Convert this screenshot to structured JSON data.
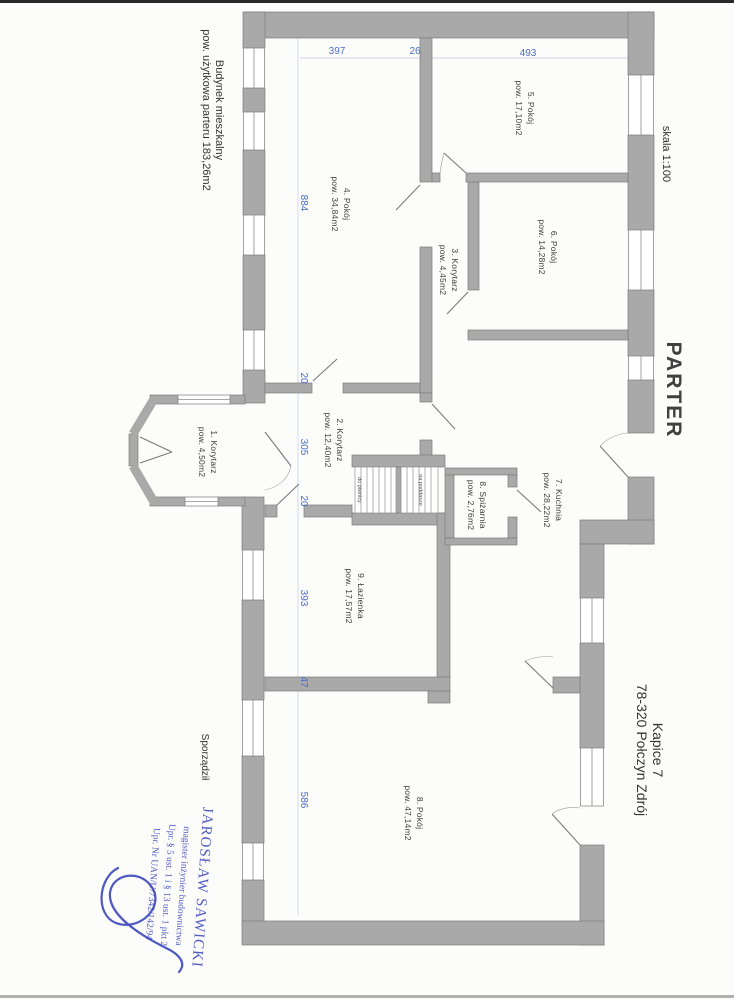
{
  "title": {
    "line1": "Budynek mieszkalny",
    "line2": "pow. użytkowa parteru 183,26m2"
  },
  "scale_label": "skala 1:100",
  "floor_label": "PARTER",
  "address": {
    "line1": "Kapice 7",
    "line2": "78-320 Połczyn Zdrój"
  },
  "prepared_by_label": "Sporządził",
  "stamp": {
    "line1": "JAROSŁAW SAWICKI",
    "line2": "magister inżynier budownictwa",
    "line3": "Upr. § 5 ust. 1 i § 13 ust. 1 pkt 2",
    "line4": "Upr. Nr UAN/U/7342/142/94"
  },
  "rooms": {
    "r1": {
      "name": "1. Korytarz",
      "area": "pow. 4,50m2"
    },
    "r2": {
      "name": "2. Korytarz",
      "area": "pow. 12,40m2"
    },
    "r3": {
      "name": "3. Korytarz",
      "area": "pow. 4,45m2"
    },
    "r4": {
      "name": "4. Pokój",
      "area": "pow. 34,84m2"
    },
    "r5": {
      "name": "5. Pokój",
      "area": "pow. 17,10m2"
    },
    "r6": {
      "name": "6. Pokój",
      "area": "pow. 14,28m2"
    },
    "r7": {
      "name": "7. Kuchnia",
      "area": "pow. 28,22m2"
    },
    "r8": {
      "name": "8. Spiżarnia",
      "area": "pow. 2,76m2"
    },
    "r9": {
      "name": "9. Łazienka",
      "area": "pow. 17,57m2"
    },
    "r10": {
      "name": "8. Pokój",
      "area": "pow. 47,14m2"
    }
  },
  "stairs": {
    "left": "do piwnicy",
    "right": "na poddasze"
  },
  "dims": {
    "t1": "397",
    "t2": "26",
    "t3": "493",
    "l1": "884",
    "l2": "20",
    "l3": "305",
    "l4": "20",
    "l5": "393",
    "l6": "47",
    "l7": "586"
  },
  "colors": {
    "wall": "#a9a9a9",
    "dimension": "#4a6cc5",
    "stamp": "#3a46bb"
  }
}
